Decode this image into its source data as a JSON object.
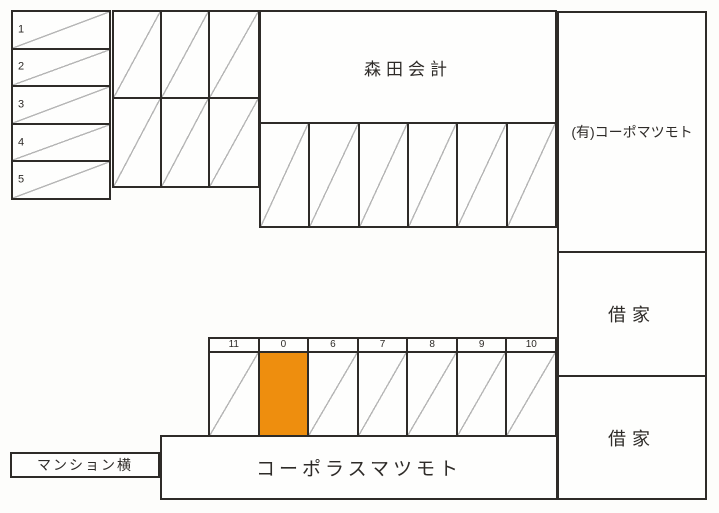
{
  "colors": {
    "line": "#2e2b28",
    "diagonal_line": "#b5b5b5",
    "highlight_orange": "#ee8e0e",
    "paper": "#fdfdfb"
  },
  "left_parking_column": {
    "stall_labels": [
      "1",
      "2",
      "3",
      "4",
      "5"
    ]
  },
  "upper_parking_grid": {
    "rows": 2,
    "cols": 3
  },
  "middle_parking_row": {
    "stall_count": 6
  },
  "buildings": {
    "morita": "森田会計",
    "corpo_matsumoto": "(有)コーポマツモト",
    "shakuya_upper": "借家",
    "shakuya_lower": "借家",
    "corporas_matsumoto": "コーポラスマツモト",
    "mansion_yoko": "マンション横"
  },
  "bottom_parking_row": {
    "stall_labels": [
      "11",
      "0",
      "6",
      "7",
      "8",
      "9",
      "10"
    ],
    "highlighted_stall": "0"
  }
}
